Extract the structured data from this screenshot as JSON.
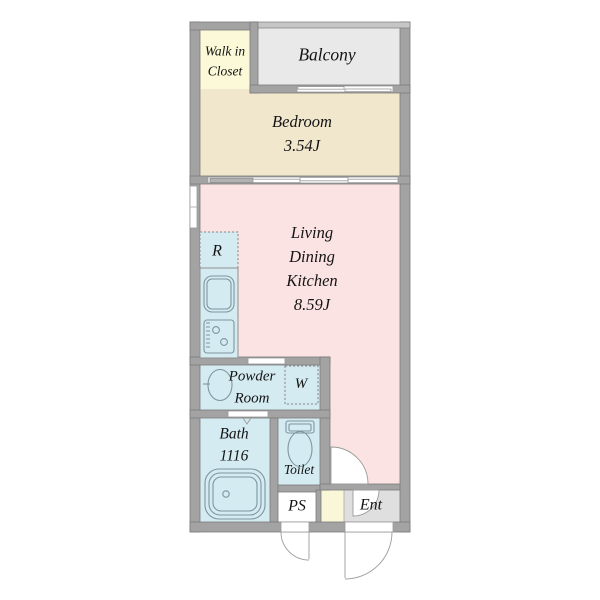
{
  "colors": {
    "wall": "#A3A3A3",
    "wall_stroke": "#7B7B7B",
    "closet": "#FBF9D8",
    "balcony": "#E9E9E9",
    "bedroom": "#F0E7CD",
    "ldk": "#FBE3E3",
    "wet": "#D4EBF1",
    "ent": "#DFDFDF",
    "shoebox": "#FAF7D8",
    "fixture": "#7E959F",
    "door": "#9B9B9B",
    "text": "#141414"
  },
  "rooms": {
    "walk_in_closet": {
      "line1": "Walk in",
      "line2": "Closet"
    },
    "balcony": {
      "label": "Balcony"
    },
    "bedroom": {
      "line1": "Bedroom",
      "line2": "3.54J"
    },
    "ldk": {
      "line1": "Living",
      "line2": "Dining",
      "line3": "Kitchen",
      "line4": "8.59J"
    },
    "refrigerator": {
      "label": "R"
    },
    "powder_room": {
      "line1": "Powder",
      "line2": "Room"
    },
    "washer": {
      "label": "W"
    },
    "bath": {
      "line1": "Bath",
      "line2": "1116"
    },
    "toilet": {
      "label": "Toilet"
    },
    "pipe_space": {
      "label": "PS"
    },
    "entrance": {
      "label": "Ent"
    }
  }
}
